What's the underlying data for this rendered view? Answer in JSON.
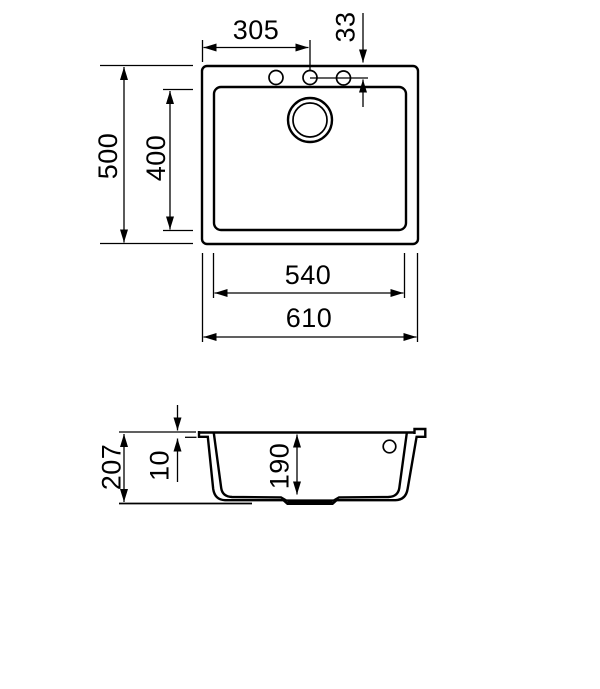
{
  "diagram": {
    "kind": "sink-technical-drawing",
    "background_color": "#ffffff",
    "line_color": "#000000",
    "top_view": {
      "dim_hole_offset_x": "305",
      "dim_hole_offset_y": "33",
      "dim_overall_front_to_back": "500",
      "dim_bowl_front_to_back": "400",
      "dim_bowl_width": "540",
      "dim_overall_width": "610"
    },
    "section_view": {
      "dim_overall_height": "207",
      "dim_rim_thickness": "10",
      "dim_bowl_inner_depth": "190"
    }
  }
}
